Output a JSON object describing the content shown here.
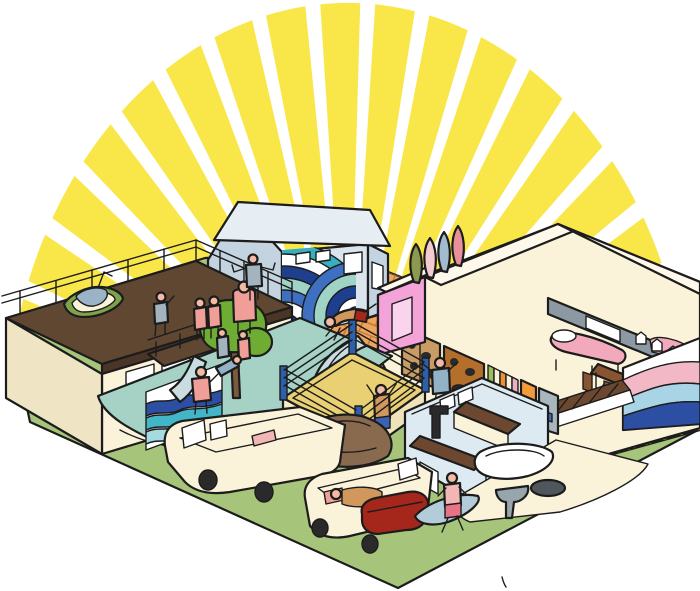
{
  "scene": {
    "description": "Isometric cartoon illustration of a sunny beachside surf-and-wrestling compound: a rooftop deck building with a boat, a wave-mural surf shack, a water slide and pool, a wrestling ring on a brick courtyard, a climbing wall, open-top rooms with beds and desks, a kitchen, outdoor bathtub and toilet, camper vans, and people, all under a rising sunburst.",
    "sun_ray_count": 17
  },
  "palette": {
    "sun_yellow": "#F9E74A",
    "ink": "#1C1C1C",
    "white": "#FFFFFF",
    "grass": "#A6C57B",
    "brick": "#EDA55C",
    "brick_line": "#C2763B",
    "cream": "#FAF3DA",
    "cream_shadow": "#EFE5C4",
    "cream_top": "#FDF8EA",
    "roof_brown": "#604732",
    "roof_edge": "#4A3526",
    "house_blue": "#D9E4ED",
    "house_blue_shadow": "#C3D3DF",
    "house_roof": "#E6EDF3",
    "mural_navy": "#1E3E8E",
    "mural_blue": "#3E6FC0",
    "mural_teal": "#38AFC0",
    "mural_seafoam": "#9ED3C6",
    "mural_pink": "#F2B8C6",
    "mural_ltblue": "#A9D4E6",
    "pink_wall": "#F3A3D7",
    "pink_door": "#FAD4EC",
    "seafoam_deck": "#A5D2C5",
    "slide_grey": "#C9DDE0",
    "water_navy": "#2C4FA3",
    "water_teal": "#42B5C6",
    "water_light": "#A5DBE0",
    "ring_mat": "#E9D173",
    "ring_apron": "#F6EDC8",
    "ring_apron_shadow": "#EFE3BA",
    "post_blue": "#2E5FA9",
    "tree_green": "#6EAC34",
    "tree_trunk": "#7B5A3E",
    "climb_tan": "#C99C63",
    "climb_orange": "#B56F2D",
    "stripe_green": "#9CBF57",
    "stripe_orange": "#E8913A",
    "stripe_pink": "#E9B0C5",
    "door_orange": "#F29B3B",
    "unit_grey": "#A9B6BE",
    "unit_blue": "#3E6FBE",
    "wall_grey": "#8C99A2",
    "bed_pink": "#F2A9BB",
    "desk_brown": "#8A5431",
    "kitchen_blue": "#DEEAF2",
    "counter_brown": "#6C4831",
    "hood_black": "#2A2A2A",
    "toilet_grey": "#97A5AD",
    "basin_dark": "#4F575D",
    "tarp_brown": "#8A6A4F",
    "couch_red": "#A5271B",
    "skin": "#F3BBA5",
    "fig_tan": "#D1975C",
    "fig_grey": "#A3B4BF",
    "fig_salmon": "#EF9E98",
    "fig_blue": "#92B2C8",
    "fig_pink": "#F2B7B5",
    "trunks_blue": "#3A62B0",
    "trunks_orange": "#E0762B",
    "shorts_pink": "#E87386",
    "board_blue": "#B3CCD9",
    "boat_green": "#7FA34A",
    "boat_cloth": "#9AB3C7",
    "board_olive": "#8B9A50",
    "board_palepink": "#F3CBD0",
    "board_steel": "#A2BBCE",
    "board_rose": "#E98F9B"
  },
  "inventory": [
    "sunburst-rays",
    "grass-lot",
    "brick-courtyard",
    "wave-mural-house",
    "rooftop-deck-building",
    "rooftop-railing",
    "rooftop-boat",
    "balcony",
    "pool-deck",
    "swimming-waves",
    "water-slide",
    "tree",
    "pink-room",
    "surfboard-display",
    "climbing-wall",
    "striped-storage-wall",
    "orange-door",
    "grey-locker",
    "bedroom",
    "beds",
    "desk-room",
    "arched-windows",
    "pastel-mural-wall",
    "lattice-wall",
    "wrestling-ring",
    "wrestlers",
    "kitchen-building",
    "range-hood",
    "counters",
    "bathtub",
    "toilet",
    "wash-basin",
    "path",
    "camper-van-1",
    "camper-van-2",
    "brown-tarp",
    "red-couch",
    "sleeping-person",
    "surfboard-carrier",
    "people"
  ]
}
